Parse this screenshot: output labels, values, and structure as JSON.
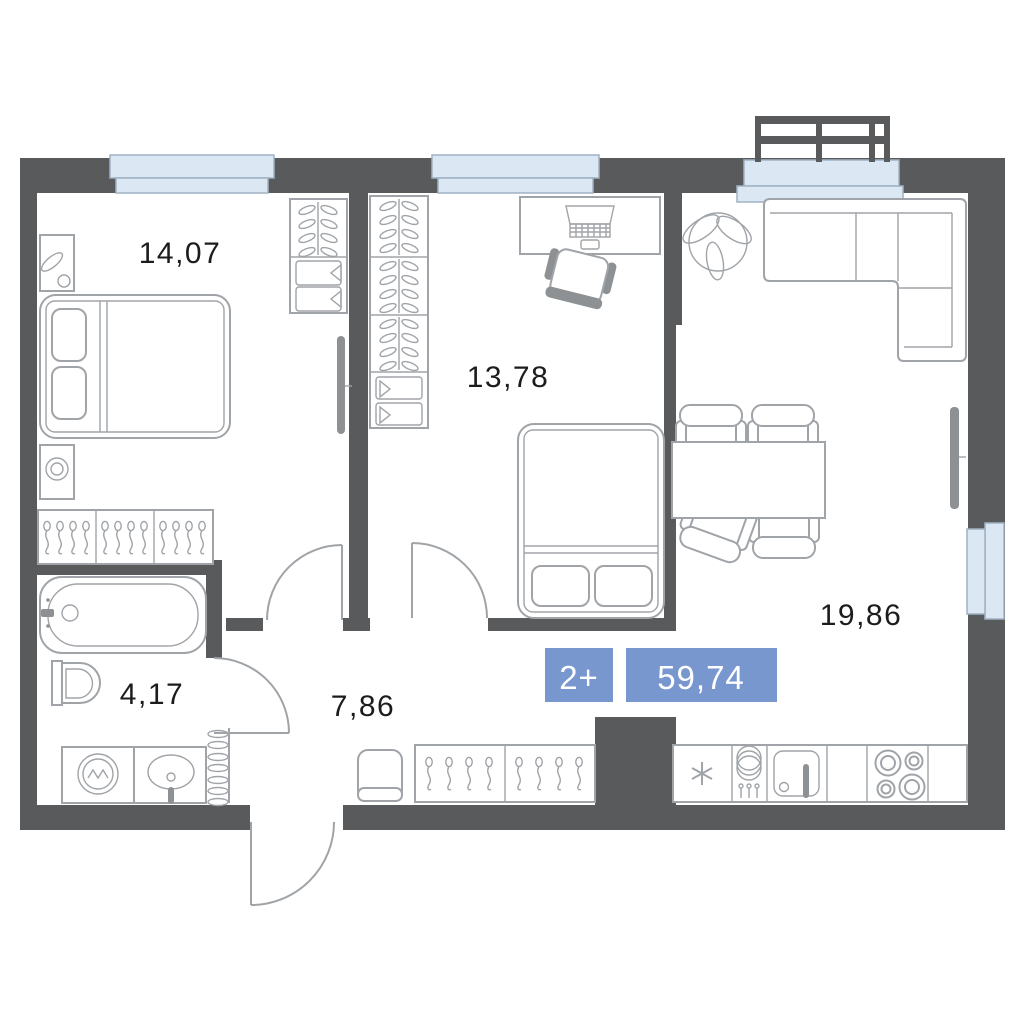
{
  "plan_type": "apartment-floor-plan",
  "badge": {
    "rooms": "2+",
    "area": "59,74"
  },
  "rooms": {
    "bedroom1": {
      "name": "bedroom-1",
      "area": "14,07"
    },
    "bedroom2": {
      "name": "bedroom-2",
      "area": "13,78"
    },
    "living": {
      "name": "living-kitchen",
      "area": "19,86"
    },
    "bathroom": {
      "name": "bathroom",
      "area": "4,17"
    },
    "hallway": {
      "name": "hallway",
      "area": "7,86"
    }
  },
  "icons": [
    "double-bed-icon",
    "single-bed-icon",
    "wardrobe-hangers-icon",
    "drawer-unit-icon",
    "coat-hooks-rack-icon",
    "desk-laptop-icon",
    "office-chair-icon",
    "corner-sofa-icon",
    "dining-table-icon",
    "dining-chair-icon",
    "plant-icon",
    "tv-icon",
    "bathtub-icon",
    "toilet-icon",
    "washing-machine-icon",
    "sink-icon",
    "towel-radiator-icon",
    "pouf-icon",
    "fridge-icon",
    "dishwasher-icon",
    "kitchen-sink-icon",
    "stove-icon",
    "balcony-railing-icon",
    "window-icon",
    "door-arc-icon"
  ],
  "colors": {
    "wall": "#595a5c",
    "furniture_line": "#a0a4a8",
    "window_fill": "#dbe7f2",
    "badge_bg": "#7897cf",
    "badge_text": "#ffffff",
    "label_text": "#1c1c1e",
    "background": "#ffffff"
  }
}
